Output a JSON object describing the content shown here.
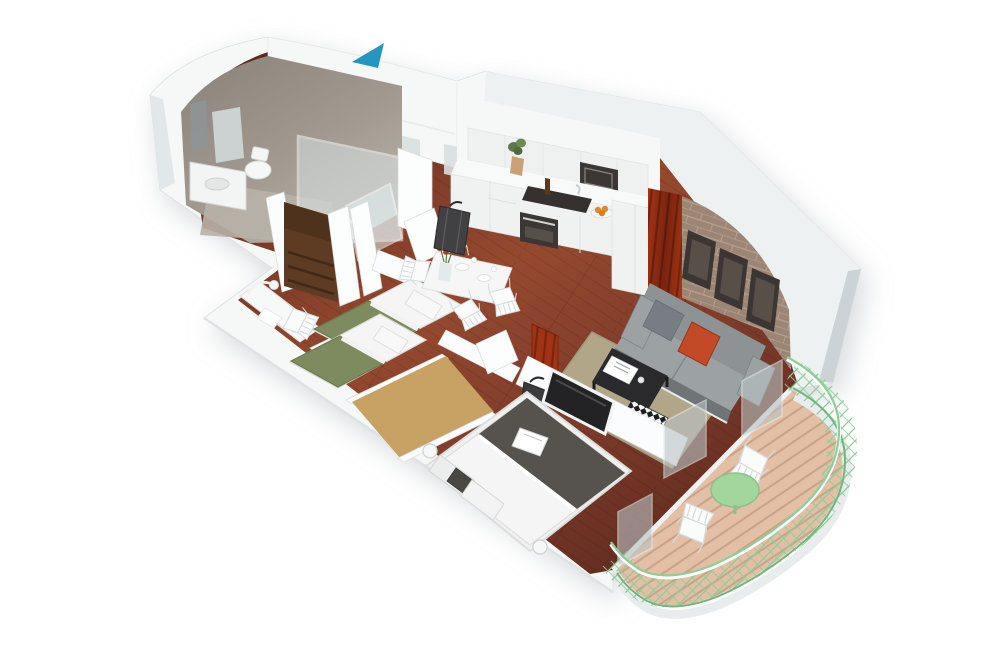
{
  "scene": {
    "type": "isometric-3d-floor-plan",
    "description": "3D cutaway rendering of a one-bedroom apartment floor plan with two twin-bed rooms, master bedroom, bathroom, open kitchen-living-dining area and a curved balcony",
    "rooms": [
      "bathroom",
      "hallway",
      "kitchen",
      "dining-area",
      "living-room",
      "bedroom-1",
      "bedroom-2",
      "walk-in-closet",
      "master-bedroom",
      "balcony"
    ],
    "entrance_marker": "teal-arrow",
    "furniture": [
      "shower",
      "vanity-sink",
      "toilet",
      "kitchen-cabinets",
      "oven",
      "microwave",
      "cooktop",
      "dining-table",
      "four-dining-chairs",
      "suitcase",
      "wardrobe-shelves",
      "desk-with-lamp",
      "twin-bed-1",
      "twin-bed-2",
      "double-bed",
      "tv",
      "sofa",
      "coffee-table",
      "rug",
      "brick-wall-with-frames",
      "red-curtain",
      "balcony-table",
      "balcony-chairs",
      "green-railing"
    ]
  },
  "colors": {
    "background": "#ffffff",
    "wall-face": "#f6f8f8",
    "wall-top": "#edf1f2",
    "wall-edge": "#d7dcde",
    "wall-shade": "#ccd3d6",
    "glass-gray": "#b9c2c4",
    "bath-wall": "#a29a90",
    "bath-wall-dark": "#8a827a",
    "bath-floor": "#b8b1a7",
    "floor-main": "#7b3a2a",
    "floor-dark": "#5e2a1e",
    "floor-light": "#95492f",
    "cabinet-white": "#f0f2f2",
    "counter-white": "#f8fafa",
    "appliance-dark": "#3a3735",
    "curtain-red": "#a23415",
    "curtain-red-dark": "#7b230f",
    "brick": "#9d8576",
    "brick-mortar": "#b7a494",
    "frame-dark": "#3b3633",
    "frame-inner": "#565049",
    "sofa-gray": "#8d9294",
    "sofa-light": "#9ca1a3",
    "sofa-dark": "#6f7476",
    "cushion-red": "#c24a27",
    "coffee-table": "#2a2a2c",
    "rug-beige": "#b2a689",
    "check-dark": "#1d1d1f",
    "bed-green": "#7e8b5e",
    "bed-green-dark": "#69774e",
    "linen-white": "#f4f5f4",
    "linen-shadow": "#d9dbd9",
    "throw-gray": "#56534e",
    "wood-brown": "#5e3c24",
    "wood-brown-dark": "#432a16",
    "closet-tan": "#c8a165",
    "deck-wood": "#e2bfa5",
    "deck-line": "#c59d82",
    "rail-green": "#8fcc9a",
    "rail-green-dark": "#6fb57e",
    "table-green": "#a3d69c",
    "arrow-teal": "#2496c0",
    "suitcase-dark": "#414043",
    "fruit-orange": "#e08a2f",
    "flower-orange": "#cc4e22"
  }
}
